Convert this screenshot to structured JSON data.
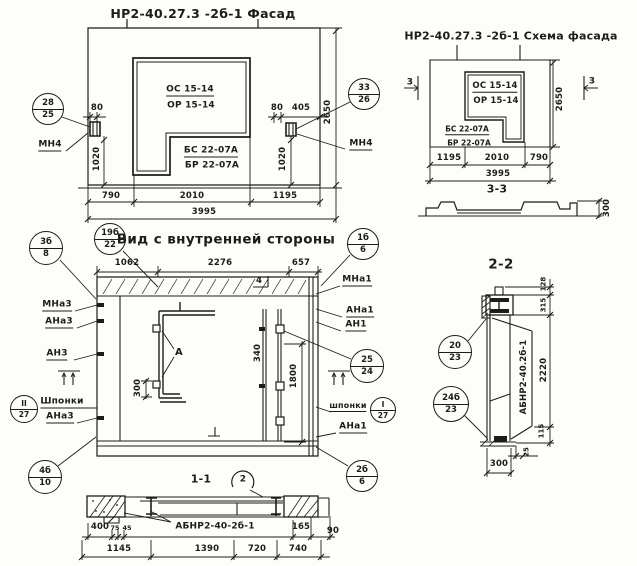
{
  "facade": {
    "title": "НР2-40.27.3 -2б-1 Фасад",
    "window_mark_line1": "ОС 15-14",
    "window_mark_line2": "ОР 15-14",
    "block_mark_line1": "БС 22-07А",
    "block_mark_line2": "БР 22-07А",
    "anchor_left": "МН4",
    "anchor_right": "МН4",
    "callout_left_top": "28",
    "callout_left_bottom": "25",
    "callout_right_top": "33",
    "callout_right_bottom": "26",
    "dim_80_left": "80",
    "dim_80_right": "80",
    "dim_405": "405",
    "dim_1020_left": "1020",
    "dim_1020_right": "1020",
    "dim_2650": "2650",
    "dim_790": "790",
    "dim_2010": "2010",
    "dim_1195": "1195",
    "dim_3995": "3995"
  },
  "scheme": {
    "title": "НР2-40.27.3 -2б-1 Схема фасада",
    "window_mark_line1": "ОС 15-14",
    "window_mark_line2": "ОР 15-14",
    "block_mark_line1": "БС 22-07А",
    "block_mark_line2": "БР 22-07А",
    "section_flag_left": "3",
    "section_flag_right": "3",
    "dim_2650": "2650",
    "dim_1195": "1195",
    "dim_2010": "2010",
    "dim_790": "790",
    "dim_3995": "3995",
    "section_label": "3-3",
    "dim_300": "300"
  },
  "inner_view": {
    "title": "Вид с внутренней стороны",
    "callout_3b_top": "3б",
    "callout_3b_bottom": "8",
    "callout_19b_top": "19б",
    "callout_19b_bottom": "22",
    "callout_4b_top": "4б",
    "callout_4b_bottom": "10",
    "callout_1b_top": "1б",
    "callout_1b_bottom": "6",
    "callout_25_top": "25",
    "callout_25_bottom": "24",
    "callout_2b_top": "2б",
    "callout_2b_bottom": "6",
    "callout_key_left_top": "II",
    "callout_key_left_bottom": "27",
    "callout_key_right_top": "I",
    "callout_key_right_bottom": "27",
    "label_mna3": "МНа3",
    "label_ana3_upper": "АНа3",
    "label_an3": "АН3",
    "label_shponki_left": "Шпонки",
    "label_ana3_lower": "АНа3",
    "label_mna1": "МНа1",
    "label_ana1_upper": "АНа1",
    "label_an1": "АН1",
    "label_shponki_right": "шпонки",
    "label_ana1_lower": "АНа1",
    "detail_marker": "А",
    "edge_marker": "4",
    "dim_1062": "1062",
    "dim_2276": "2276",
    "dim_657": "657",
    "dim_300": "300",
    "dim_340": "340",
    "dim_1800": "1800"
  },
  "section_1_1": {
    "title": "1-1",
    "detail_marker": "2",
    "part_label": "АБНР2-40-2б-1",
    "dim_400": "400",
    "dim_75": "75",
    "dim_45": "45",
    "dim_165": "165",
    "dim_90": "90",
    "dim_1145": "1145",
    "dim_1390": "1390",
    "dim_720": "720",
    "dim_740": "740"
  },
  "section_2_2": {
    "title": "2-2",
    "callout_20_top": "20",
    "callout_20_bottom": "23",
    "callout_24b_top": "24б",
    "callout_24b_bottom": "23",
    "part_label": "АБНР2-40.2б-1",
    "dim_128": "128",
    "dim_315": "315",
    "dim_2220": "2220",
    "dim_115": "115",
    "dim_25": "25",
    "dim_300": "300"
  }
}
